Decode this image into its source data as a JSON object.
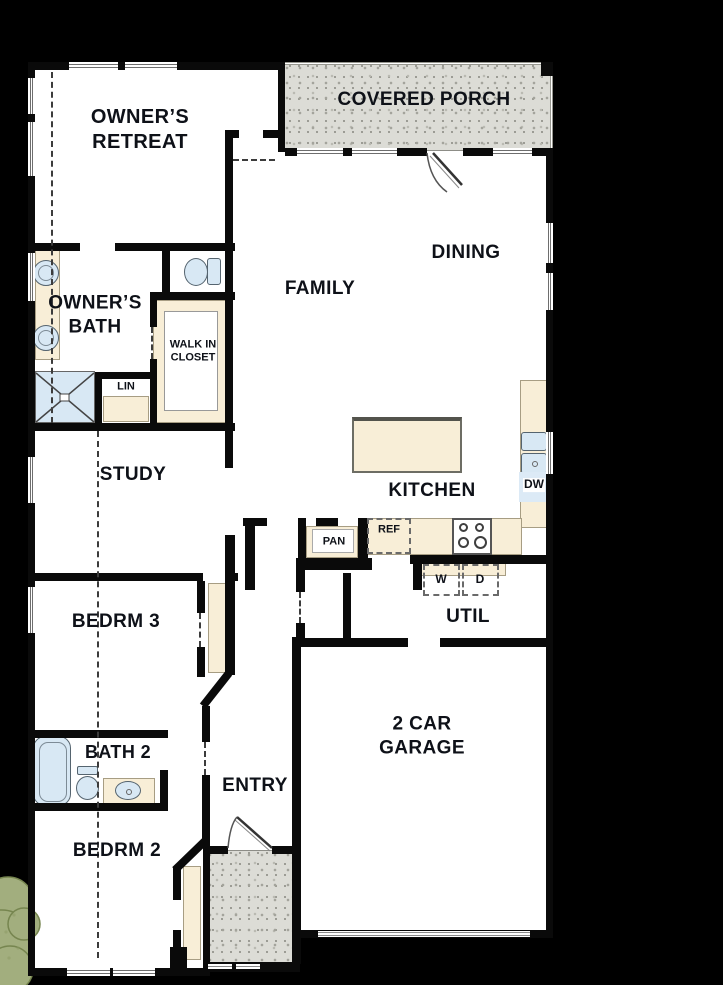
{
  "title": "Single-story floor plan",
  "colors": {
    "background": "#000000",
    "wall": "#0a0a0a",
    "floor": "#ffffff",
    "cabinet_cream": "#f8eed7",
    "fixture_blue": "#d8e8f4",
    "porch_gray": "#dcdcd6",
    "tree_green": "#a2ae7e"
  },
  "rooms": {
    "owners_retreat": "OWNER’S\nRETREAT",
    "covered_porch": "COVERED PORCH",
    "dining": "DINING",
    "family": "FAMILY",
    "owners_bath": "OWNER’S\nBATH",
    "walk_in_closet": "WALK IN\nCLOSET",
    "lin": "LIN",
    "study": "STUDY",
    "kitchen": "KITCHEN",
    "pantry": "PAN",
    "refrigerator": "REF",
    "dishwasher": "DW",
    "washer": "W",
    "dryer": "D",
    "utility": "UTIL",
    "bedroom3": "BEDRM 3",
    "garage": "2 CAR\nGARAGE",
    "bath2": "BATH 2",
    "entry": "ENTRY",
    "bedroom2": "BEDRM 2"
  }
}
